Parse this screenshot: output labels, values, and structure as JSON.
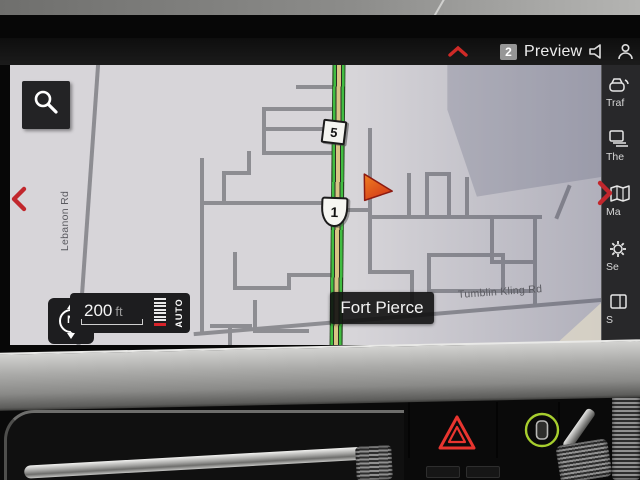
{
  "status_bar": {
    "badge_count": "2",
    "preview_label": "Preview",
    "icons": [
      "chevron-up-icon",
      "volume-icon",
      "driver-profile-icon"
    ]
  },
  "map": {
    "city_label": "Fort Pierce",
    "road_label_left": "Lebanon Rd",
    "road_label_bottom": "Tumblin Kling Rd",
    "shield_square": "5",
    "shield_us": "1",
    "scale_number": "200",
    "scale_unit": "ft",
    "scale_mode": "AUTO",
    "compass_label": "N",
    "icons": [
      "search-icon",
      "compass-icon",
      "position-arrow-icon",
      "scroll-left-icon",
      "scroll-right-icon"
    ]
  },
  "sidebar": {
    "items": [
      {
        "label": "Traf",
        "icon": "traffic-icon"
      },
      {
        "label": "The",
        "icon": "layers-icon"
      },
      {
        "label": "Ma",
        "icon": "map-icon"
      },
      {
        "label": "Se",
        "icon": "settings-icon"
      },
      {
        "label": "S",
        "icon": "panel-icon"
      }
    ]
  },
  "console": {
    "icons": [
      "hazard-warning-icon",
      "parking-assist-icon"
    ]
  },
  "colors": {
    "route_green": "#41bd41",
    "route_tan": "#d8c385",
    "accent_red": "#c1272d",
    "hazard_red": "#e8352f",
    "button_green": "#a7ce2e"
  }
}
